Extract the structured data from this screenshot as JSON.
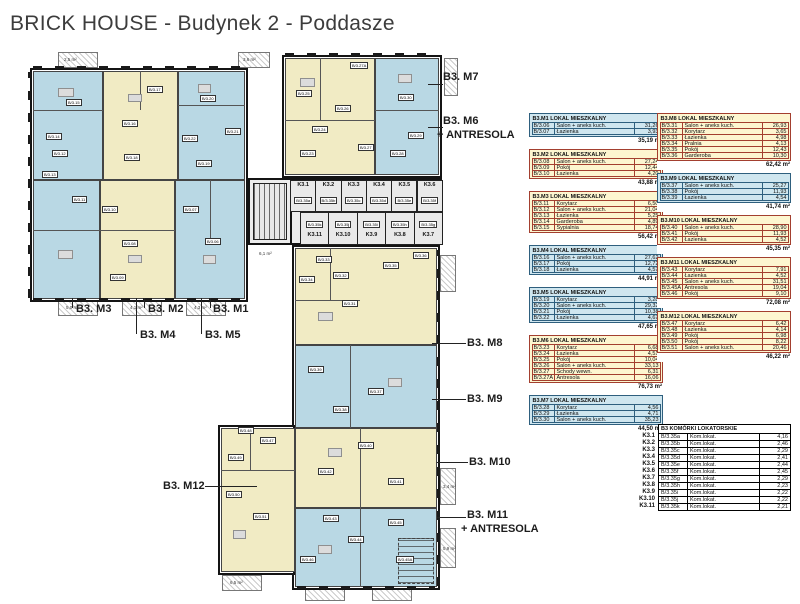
{
  "title": "BRICK HOUSE - Budynek 2 - Poddasze",
  "colors": {
    "plan_blue": "#b9d8e4",
    "plan_yellow": "#f1ebc4",
    "table_blue_bg": "#cfe6ef",
    "table_blue_border": "#2e5f7e",
    "table_yellow_bg": "#fdf6d0",
    "table_yellow_border": "#a33f2f",
    "walls": "#141414"
  },
  "units": [
    {
      "id": "M1",
      "plan_label": "B3. M1",
      "table_title": "B3.M1 LOKAL MIESZKALNY",
      "color": "blue",
      "column": 1,
      "rows": [
        [
          "B/3.06",
          "Salon + aneks kuch.",
          "31,26"
        ],
        [
          "B/3.07",
          "Łazienka",
          "3,93"
        ]
      ],
      "total": "35,19 m²"
    },
    {
      "id": "M2",
      "plan_label": "B3. M2",
      "table_title": "B3.M2 LOKAL MIESZKALNY",
      "color": "yellow",
      "column": 1,
      "rows": [
        [
          "B/3.08",
          "Salon + aneks kuch.",
          "27,24"
        ],
        [
          "B/3.09",
          "Pokój",
          "12,44"
        ],
        [
          "B/3.10",
          "Łazienka",
          "4,20"
        ]
      ],
      "total": "43,88 m²"
    },
    {
      "id": "M3",
      "plan_label": "B3. M3",
      "table_title": "B3.M3 LOKAL MIESZKALNY",
      "color": "yellow",
      "column": 1,
      "rows": [
        [
          "B/3.11",
          "Korytarz",
          "6,50"
        ],
        [
          "B/3.12",
          "Salon + aneks kuch.",
          "21,04"
        ],
        [
          "B/3.13",
          "Łazienka",
          "5,25"
        ],
        [
          "B/3.14",
          "Garderoba",
          "4,89"
        ],
        [
          "B/3.15",
          "Sypialnia",
          "18,74"
        ]
      ],
      "total": "56,42 m²"
    },
    {
      "id": "M4",
      "plan_label": "B3. M4",
      "table_title": "B3.M4 LOKAL MIESZKALNY",
      "color": "blue",
      "column": 1,
      "rows": [
        [
          "B/3.16",
          "Salon + aneks kuch.",
          "27,62"
        ],
        [
          "B/3.17",
          "Pokój",
          "12,72"
        ],
        [
          "B/3.18",
          "Łazienka",
          "4,57"
        ]
      ],
      "total": "44,91 m²"
    },
    {
      "id": "M5",
      "plan_label": "B3. M5",
      "table_title": "B3.M5 LOKAL MIESZKALNY",
      "color": "blue",
      "column": 1,
      "rows": [
        [
          "B/3.19",
          "Korytarz",
          "3,28"
        ],
        [
          "B/3.20",
          "Salon + aneks kuch.",
          "29,32"
        ],
        [
          "B/3.21",
          "Pokój",
          "10,38"
        ],
        [
          "B/3.22",
          "Łazienka",
          "4,67"
        ]
      ],
      "total": "47,65 m²"
    },
    {
      "id": "M6",
      "plan_label": "B3. M6",
      "extra": "+ ANTRESOLA",
      "table_title": "B3.M6 LOKAL MIESZKALNY",
      "color": "yellow",
      "column": 1,
      "rows": [
        [
          "B/3.23",
          "Korytarz",
          "6,68"
        ],
        [
          "B/3.24",
          "Łazienka",
          "4,51"
        ],
        [
          "B/3.25",
          "Pokój",
          "10,04"
        ],
        [
          "B/3.26",
          "Salon + aneks kuch.",
          "33,13"
        ],
        [
          "B/3.27",
          "Schody wewn.",
          "6,31"
        ],
        [
          "B/3.27A",
          "Antresola",
          "16,06"
        ]
      ],
      "total": "76,73 m²"
    },
    {
      "id": "M7",
      "plan_label": "B3. M7",
      "table_title": "B3.M7 LOKAL MIESZKALNY",
      "color": "blue",
      "column": 1,
      "rows": [
        [
          "B/3.28",
          "Korytarz",
          "4,56"
        ],
        [
          "B/3.29",
          "Łazienka",
          "4,71"
        ],
        [
          "B/3.30",
          "Salon + aneks kuch.",
          "35,23"
        ]
      ],
      "total": "44,50 m²"
    },
    {
      "id": "M8",
      "plan_label": "B3. M8",
      "table_title": "B3.M8 LOKAL MIESZKALNY",
      "color": "yellow",
      "column": 2,
      "rows": [
        [
          "B/3.31",
          "Salon + aneks kuch.",
          "26,93"
        ],
        [
          "B/3.32",
          "Korytarz",
          "3,65"
        ],
        [
          "B/3.33",
          "Łazienka",
          "4,98"
        ],
        [
          "B/3.34",
          "Pralnia",
          "4,13"
        ],
        [
          "B/3.35",
          "Pokój",
          "12,43"
        ],
        [
          "B/3.36",
          "Garderoba",
          "10,30"
        ]
      ],
      "total": "62,42 m²"
    },
    {
      "id": "M9",
      "plan_label": "B3. M9",
      "table_title": "B3.M9 LOKAL MIESZKALNY",
      "color": "blue",
      "column": 2,
      "rows": [
        [
          "B/3.37",
          "Salon + aneks kuch.",
          "25,27"
        ],
        [
          "B/3.38",
          "Pokój",
          "11,93"
        ],
        [
          "B/3.39",
          "Łazienka",
          "4,54"
        ]
      ],
      "total": "41,74 m²"
    },
    {
      "id": "M10",
      "plan_label": "B3. M10",
      "table_title": "B3.M10 LOKAL MIESZKALNY",
      "color": "yellow",
      "column": 2,
      "rows": [
        [
          "B/3.40",
          "Salon + aneks kuch.",
          "28,90"
        ],
        [
          "B/3.41",
          "Pokój",
          "11,93"
        ],
        [
          "B/3.42",
          "Łazienka",
          "4,52"
        ]
      ],
      "total": "45,35 m²"
    },
    {
      "id": "M11",
      "plan_label": "B3. M11",
      "extra": "+ ANTRESOLA",
      "table_title": "B3.M11 LOKAL MIESZKALNY",
      "color": "yellow",
      "column": 2,
      "rows": [
        [
          "B/3.43",
          "Korytarz",
          "7,91"
        ],
        [
          "B/3.44",
          "Łazienka",
          "4,52"
        ],
        [
          "B/3.45",
          "Salon + aneks kuch.",
          "31,51"
        ],
        [
          "B/3.45A",
          "Antresola",
          "19,04"
        ],
        [
          "B/3.46",
          "Pokój",
          "9,10"
        ]
      ],
      "total": "72,08 m²"
    },
    {
      "id": "M12",
      "plan_label": "B3. M12",
      "table_title": "B3.M12 LOKAL MIESZKALNY",
      "color": "yellow",
      "column": 2,
      "rows": [
        [
          "B/3.47",
          "Korytarz",
          "6,42"
        ],
        [
          "B/3.48",
          "Łazienka",
          "4,14"
        ],
        [
          "B/3.49",
          "Pokój",
          "6,98"
        ],
        [
          "B/3.50",
          "Pokój",
          "8,22"
        ],
        [
          "B/3.51",
          "Salon + aneks kuch.",
          "20,46"
        ]
      ],
      "total": "46,22 m²"
    }
  ],
  "komorki": {
    "title": "B3 KOMÓRKI LOKATORSKIE",
    "rows": [
      [
        "K3.1",
        "B/3.35a",
        "Kom.lokat.",
        "4,16"
      ],
      [
        "K3.2",
        "B/3.35b",
        "Kom.lokat.",
        "2,46"
      ],
      [
        "K3.3",
        "B/3.35c",
        "Kom.lokat.",
        "2,29"
      ],
      [
        "K3.4",
        "B/3.35d",
        "Kom.lokat.",
        "2,41"
      ],
      [
        "K3.5",
        "B/3.35e",
        "Kom.lokat.",
        "2,44"
      ],
      [
        "K3.6",
        "B/3.35f",
        "Kom.lokat.",
        "2,45"
      ],
      [
        "K3.7",
        "B/3.35g",
        "Kom.lokat.",
        "2,29"
      ],
      [
        "K3.8",
        "B/3.35h",
        "Kom.lokat.",
        "2,23"
      ],
      [
        "K3.9",
        "B/3.35i",
        "Kom.lokat.",
        "2,22"
      ],
      [
        "K3.10",
        "B/3.35j",
        "Kom.lokat.",
        "2,22"
      ],
      [
        "K3.11",
        "B/3.35k",
        "Kom.lokat.",
        "2,21"
      ]
    ]
  },
  "plan": {
    "storage_top": [
      "K3.1",
      "K3.2",
      "K3.3",
      "K3.4",
      "K3.5",
      "K3.6"
    ],
    "storage_bottom": [
      "K3.11",
      "K3.10",
      "K3.9",
      "K3.8",
      "K3.7"
    ],
    "area_labels": [
      "2,5 m²",
      "3,6 m²",
      "5,0 m²",
      "4,1 m²",
      "4,3 m²",
      "6,1 m²",
      "6,5 m²",
      "3,4 m²",
      "5,9 m²"
    ]
  }
}
